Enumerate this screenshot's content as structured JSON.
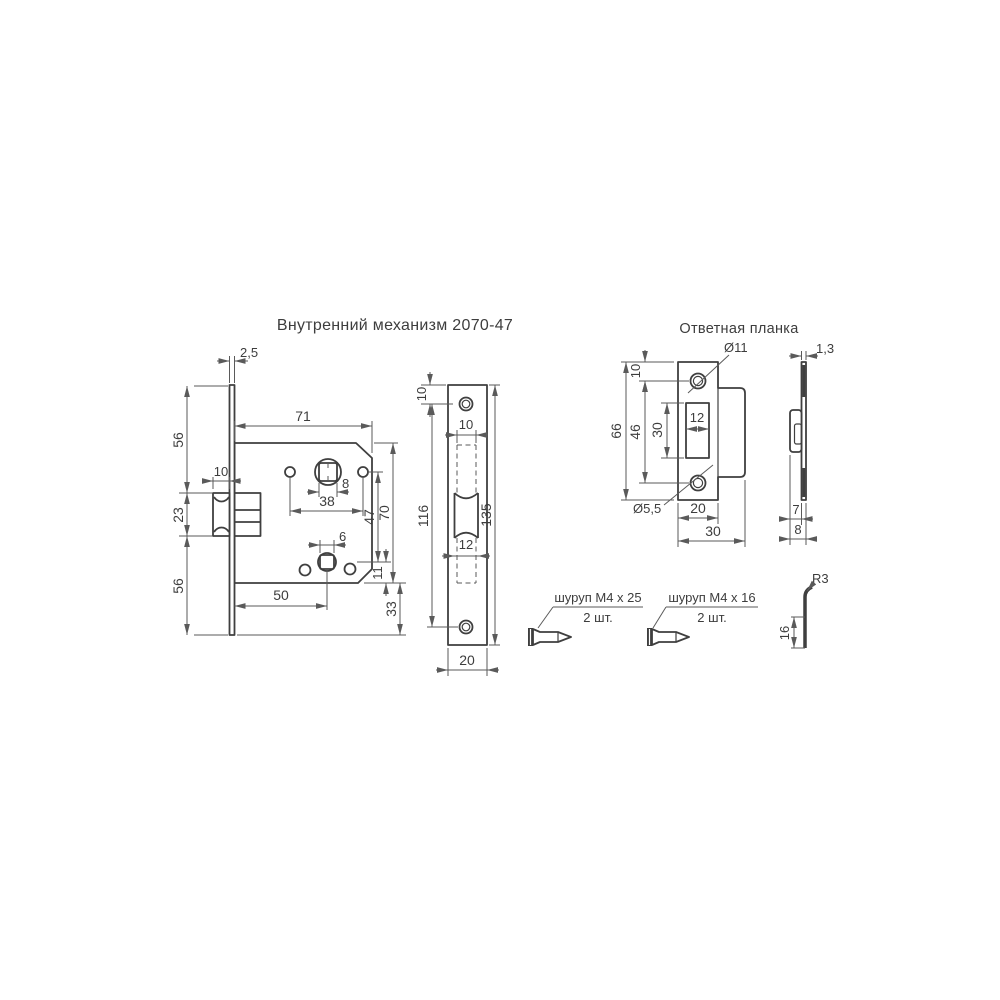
{
  "titles": {
    "mechanism": "Внутренний механизм 2070-47",
    "strike_plate": "Ответная планка"
  },
  "colors": {
    "line": "#3f3f3f",
    "dimension": "#5a5a5a"
  },
  "mechanism_view": {
    "dims": {
      "faceplate_thickness": "2,5",
      "top_offset": "56",
      "latch_height": "23",
      "bottom_offset": "56",
      "latch_protrusion": "10",
      "body_width": "71",
      "spindle_square": "8",
      "fixing_holes_span": "38",
      "spindle_to_key": "47",
      "body_height": "70",
      "key_square": "6",
      "key_to_bottom": "11",
      "backset": "50",
      "bottom_extension": "33"
    }
  },
  "faceplate_view": {
    "dims": {
      "top_to_hole": "10",
      "cutout_width": "10",
      "latch_width": "12",
      "holes_span": "116",
      "height": "135",
      "width": "20"
    }
  },
  "strike_plate_view": {
    "dims": {
      "hole_diameter": "Ø11",
      "thickness": "1,3",
      "top_to_hole": "10",
      "holes_span": "46",
      "cutout_height": "30",
      "height": "66",
      "cutout_width": "12",
      "countersink_diameter": "Ø5,5",
      "plate_width": "20",
      "total_width": "30",
      "tab_depth": "7",
      "total_depth": "8"
    }
  },
  "screws": [
    {
      "label": "шуруп M4 x 25",
      "qty": "2 шт."
    },
    {
      "label": "шуруп M4 x 16",
      "qty": "2 шт."
    }
  ],
  "tab_detail": {
    "bend_radius": "R3",
    "tab_length": "16"
  }
}
